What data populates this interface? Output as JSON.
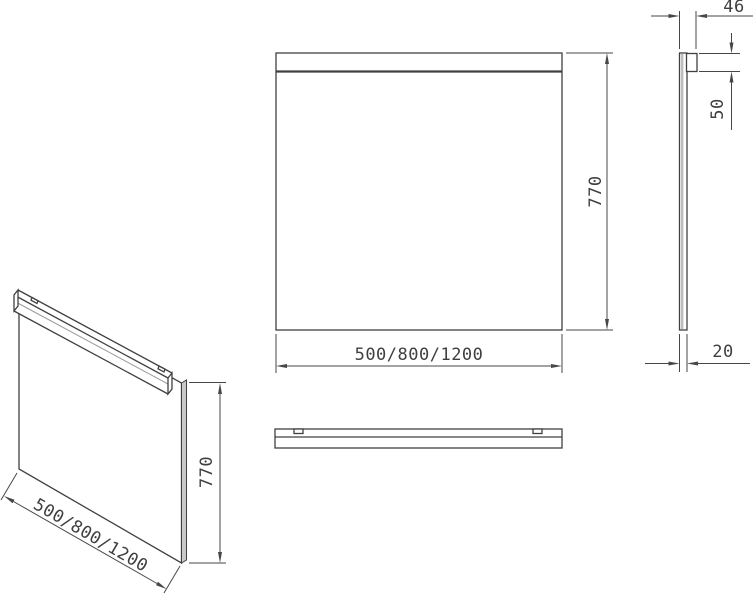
{
  "drawing": {
    "kind": "technical-drawing-mirror-panel",
    "views": {
      "isometric": {
        "width_label": "500/800/1200",
        "height_label": "770"
      },
      "front": {
        "width_label": "500/800/1200",
        "height_label": "770"
      },
      "side": {
        "total_depth_label": "46",
        "rail_height_label": "50",
        "panel_thickness_label": "20"
      }
    },
    "colors": {
      "line": "#404040",
      "background": "#ffffff",
      "glass_shade": "#bdbdbd"
    }
  }
}
